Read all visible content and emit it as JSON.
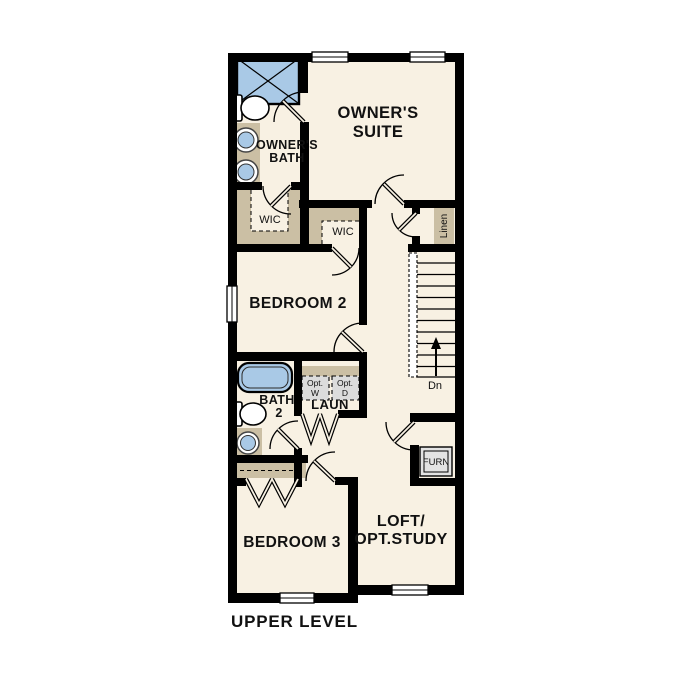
{
  "title": "UPPER LEVEL",
  "colors": {
    "background": "#ffffff",
    "walls": "#000000",
    "floor": "#f8f1e3",
    "cabinets_tan": "#cbbfa4",
    "fixtures_blue": "#a9c9e6",
    "appliance_gray": "#dcdcdc"
  },
  "rooms": {
    "owners_suite": {
      "line1": "OWNER'S",
      "line2": "SUITE"
    },
    "owners_bath": {
      "line1": "OWNER'S",
      "line2": "BATH"
    },
    "wic1": {
      "label": "WIC"
    },
    "wic2": {
      "label": "WIC"
    },
    "linen": {
      "label": "Linen"
    },
    "bedroom2": {
      "label": "BEDROOM 2"
    },
    "bath2": {
      "line1": "BATH",
      "line2": "2"
    },
    "laundry": {
      "label": "LAUN",
      "opt_washer": {
        "line1": "Opt.",
        "line2": "W"
      },
      "opt_dryer": {
        "line1": "Opt.",
        "line2": "D"
      }
    },
    "stairs": {
      "down_label": "Dn"
    },
    "furnace": {
      "label": "FURN"
    },
    "bedroom3": {
      "label": "BEDROOM 3"
    },
    "loft": {
      "line1": "LOFT/",
      "line2": "OPT.STUDY"
    }
  }
}
